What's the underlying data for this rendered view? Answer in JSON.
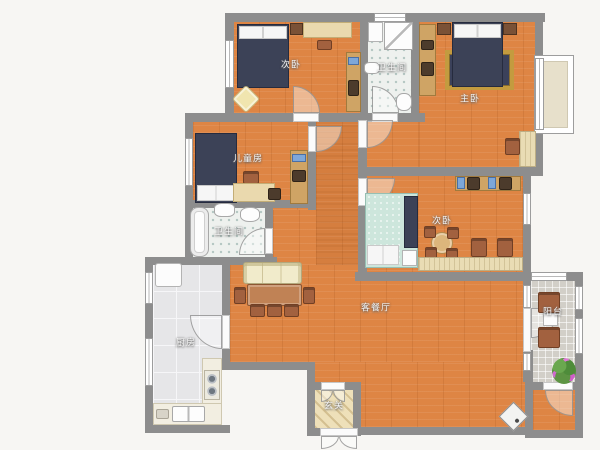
{
  "floor_plan": {
    "type": "apartment-2d-floor-plan",
    "rooms": [
      {
        "id": "secondary-bedroom-top",
        "label": "次卧"
      },
      {
        "id": "bathroom-top",
        "label": "卫生间"
      },
      {
        "id": "master-bedroom",
        "label": "主卧"
      },
      {
        "id": "children-room",
        "label": "儿童房"
      },
      {
        "id": "bathroom-lower",
        "label": "卫生间"
      },
      {
        "id": "secondary-bedroom-right",
        "label": "次卧"
      },
      {
        "id": "living-dining-room",
        "label": "客餐厅"
      },
      {
        "id": "kitchen",
        "label": "厨房"
      },
      {
        "id": "entrance-hall",
        "label": "玄关"
      },
      {
        "id": "balcony",
        "label": "阳台"
      }
    ],
    "colors": {
      "background": "#f7f6f3",
      "wall": "#8d8d8d",
      "wood_floor": "#de8544",
      "bathroom_tile": "#eef1ee",
      "kitchen_tile": "#e6e6e8",
      "balcony_tile": "#d2cfc8",
      "entrance_floor": "#eee0b9",
      "bed_dark": "#3c4257",
      "bed_teal": "#cde6dc",
      "furniture_brown": "#a2613f",
      "cabinet_tan": "#cfa465",
      "sofa_cream": "#f1ebcb",
      "rug_border_gold": "#c39b3f"
    }
  }
}
